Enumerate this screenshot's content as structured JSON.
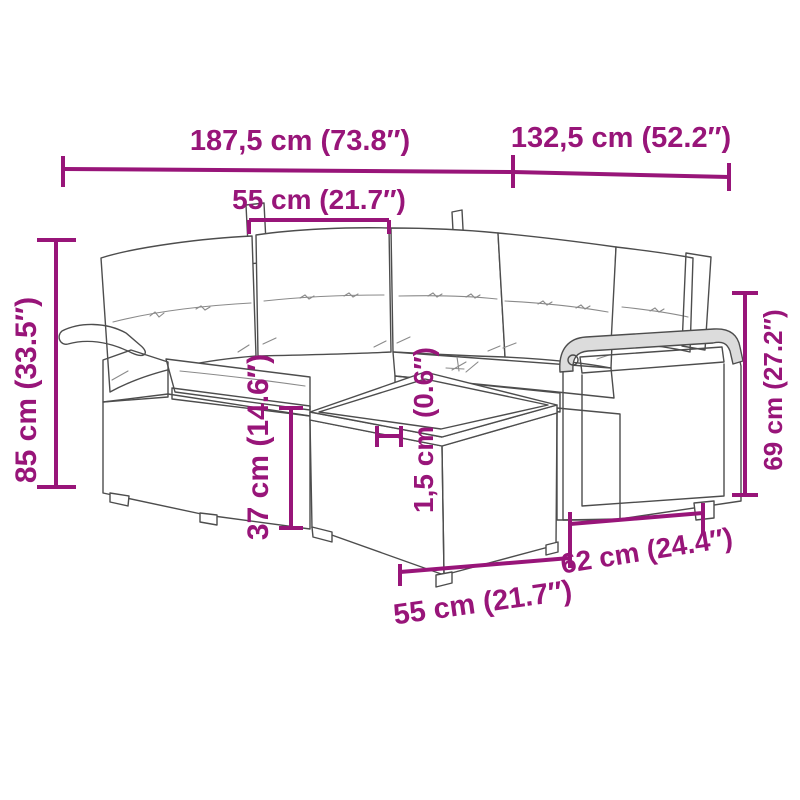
{
  "image_type": "product-dimension-diagram",
  "accent_color": "#981579",
  "illustration": {
    "subject": "rattan-corner-sofa-set-with-cushions-and-coffee-table",
    "back_cushion_count": 5
  },
  "dimensions": {
    "total_width": "187,5 cm (73.8″)",
    "total_depth": "132,5 cm (52.2″)",
    "seat_width": "55 cm (21.7″)",
    "overall_height": "85 cm (33.5″)",
    "table_height": "37 cm (14.6″)",
    "tabletop_thickness": "1,5 cm (0.6″)",
    "arm_height": "69 cm (27.2″)",
    "side_depth": "62 cm (24.4″)",
    "table_width": "55 cm (21.7″)"
  }
}
